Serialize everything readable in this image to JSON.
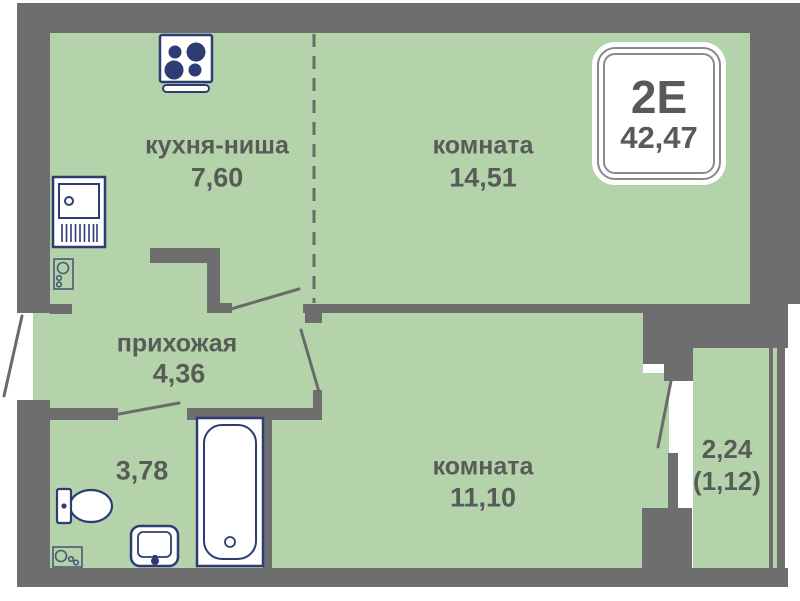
{
  "plan": {
    "badge": {
      "type": "2Е",
      "total_area": "42,47"
    },
    "rooms": {
      "kitchen": {
        "label": "кухня-ниша",
        "area": "7,60"
      },
      "living_room": {
        "label": "комната",
        "area": "14,51"
      },
      "hallway": {
        "label": "прихожая",
        "area": "4,36"
      },
      "bathroom": {
        "area": "3,78"
      },
      "bedroom": {
        "label": "комната",
        "area": "11,10"
      },
      "balcony": {
        "area": "2,24",
        "area_coefficient": "(1,12)"
      }
    },
    "colors": {
      "floor": "#b5d3ab",
      "wall": "#6e6e6e",
      "fixtures": "#2e3c74",
      "text": "#575c57",
      "background": "#ffffff"
    },
    "icons": [
      "stove-icon",
      "kitchen-sink-icon",
      "vent-shaft-icon",
      "toilet-icon",
      "washbasin-icon",
      "bathtub-icon",
      "door-swing-line",
      "dashed-zone-divider"
    ]
  }
}
